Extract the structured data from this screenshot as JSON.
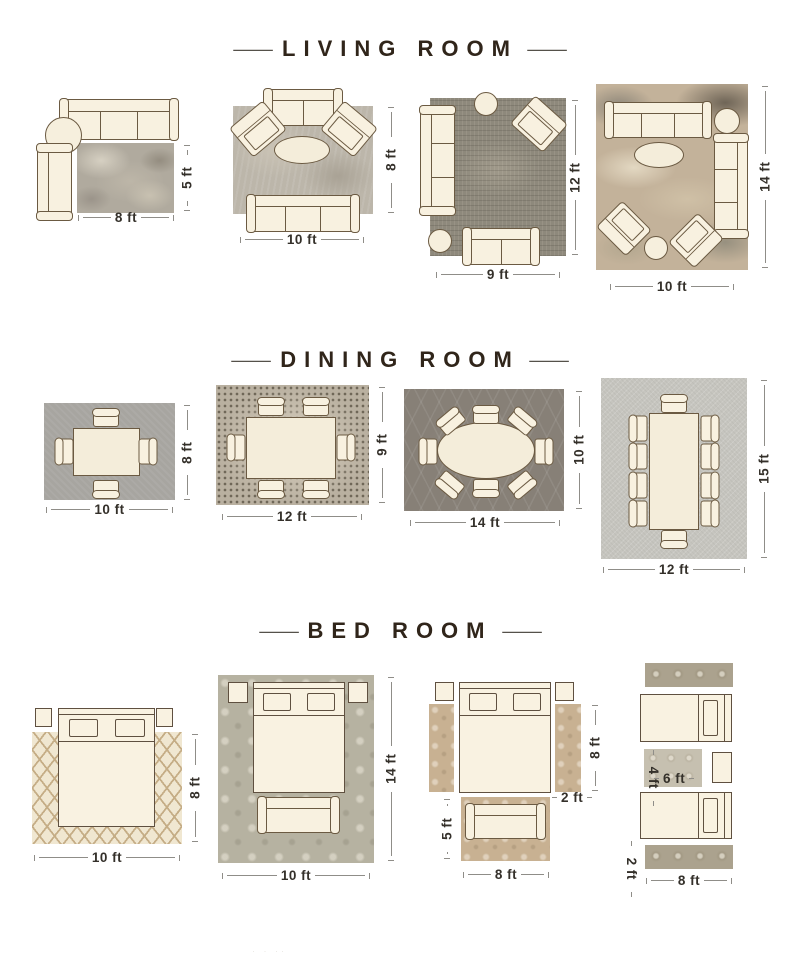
{
  "dash": "—",
  "titles": {
    "living": "LIVING ROOM",
    "dining": "DINING ROOM",
    "bedroom": "BED ROOM"
  },
  "living": {
    "l1": {
      "w": "8 ft",
      "h": "5 ft"
    },
    "l2": {
      "w": "10 ft",
      "h": "8 ft"
    },
    "l3": {
      "w": "9 ft",
      "h": "12 ft"
    },
    "l4": {
      "w": "10 ft",
      "h": "14 ft"
    }
  },
  "dining": {
    "d1": {
      "w": "10 ft",
      "h": "8 ft"
    },
    "d2": {
      "w": "12 ft",
      "h": "9 ft"
    },
    "d3": {
      "w": "14 ft",
      "h": "10 ft"
    },
    "d4": {
      "w": "12 ft",
      "h": "15 ft"
    }
  },
  "bedroom": {
    "b1": {
      "w": "10 ft",
      "h": "8 ft"
    },
    "b2": {
      "w": "10 ft",
      "h": "14 ft"
    },
    "b3": {
      "w": "8 ft",
      "bed_runner_h": "8 ft",
      "runner_w": "2 ft",
      "rug_h": "5 ft"
    },
    "b4": {
      "w": "8 ft",
      "runner_w": "2 ft",
      "mid_rug_w": "6 ft",
      "mid_rug_h": "4 ft"
    }
  },
  "footer": {
    "mark": "· · ··"
  },
  "colors": {
    "furniture_fill": "#f8f1e0",
    "furniture_outline": "#6b5a42",
    "title_text": "#30251a",
    "dimension_text": "#34302a",
    "dimension_line": "#8f8d88",
    "background": "#ffffff"
  }
}
